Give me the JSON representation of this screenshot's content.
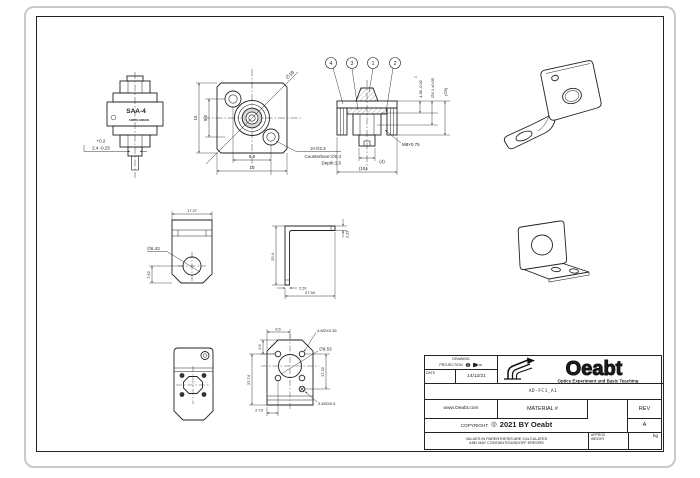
{
  "drawing": {
    "adapter": {
      "label": "SAA-4",
      "brand": "SIMON GREEN",
      "tol": "+0.2",
      "dim": "2.4 -0.25"
    },
    "front": {
      "dia": "∅19",
      "h_out": "15",
      "h_in": "9.5",
      "w_in": "9.5",
      "w_out": "15",
      "note1": "2×∅2.3",
      "note2": "Counterbore:∅0.4",
      "note3": "Depth:1.5"
    },
    "section": {
      "balloon1": "4",
      "balloon2": "3",
      "balloon3": "1",
      "balloon4": "2",
      "tol0": "0",
      "dim_a": "4.38 -0.02",
      "dim_b": "∅6.1 ±0.05",
      "dim_c": "(∅9)",
      "thread": "M8×0.75",
      "dim_d": "(4)",
      "dim_e": "(15)"
    },
    "bracket_front": {
      "w": "17.27",
      "dia": "∅6.43",
      "hy": "7.62"
    },
    "bracket_side": {
      "h": "25.4",
      "t": "2.29",
      "foot": "2.29",
      "w": "27.94"
    },
    "bracket_dims": {
      "top": "9.5",
      "a": "4.5",
      "left": "22.74",
      "right": "17.32",
      "bottom": "2.79",
      "dia": "∅9.53",
      "note_top": "4-M2X0.35",
      "note_bottom": "3-M3X0.5"
    }
  },
  "title_block": {
    "proj1": "DRAWING",
    "proj2": "PROJECTION",
    "date_label": "DATE",
    "date_value": "14/12/21",
    "brand": "Oeabt",
    "tagline": "Optics Experiment and Basic Teaching",
    "part_number": "AD-FC1_A1",
    "website": "www.Oeabt.com",
    "material_label": "MATERIAL #",
    "rev_label": "REV",
    "rev_value": "A",
    "copyright_label": "COPYRIGHT",
    "copyright_mark": "◎",
    "copyright_value": "2021 BY Oeabt",
    "disclaimer1": "VALUES IN PARENTHESIS ARE CALCULATED",
    "disclaimer2": "AND MAY CONTAIN ROUNDOFF ERRORS",
    "weight_label1": "APPROX",
    "weight_label2": "WEIGHT",
    "weight_unit": "kg"
  },
  "colors": {
    "line": "#222222",
    "frame_gray": "#c9c9c9",
    "ring_fill": "#d4d4d4"
  }
}
